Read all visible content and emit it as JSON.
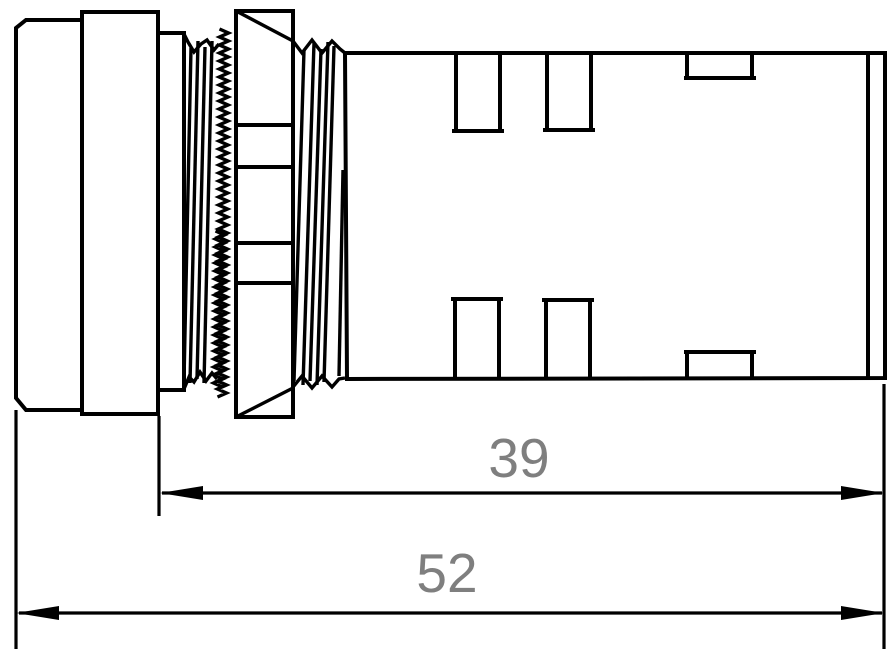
{
  "drawing": {
    "description": "Side-view technical line drawing of a panel-mount indicator light: front bezel, flange ring, gasket washer, threaded bushing with serrated lock washer, hex mounting nut, and rear housing with terminal slots",
    "line_color": "#000000",
    "dimension_text_color": "#7f7f7f",
    "background_color": "#ffffff"
  },
  "dimensions": [
    {
      "id": "behind-panel-length",
      "label": "39"
    },
    {
      "id": "overall-length",
      "label": "52"
    }
  ]
}
